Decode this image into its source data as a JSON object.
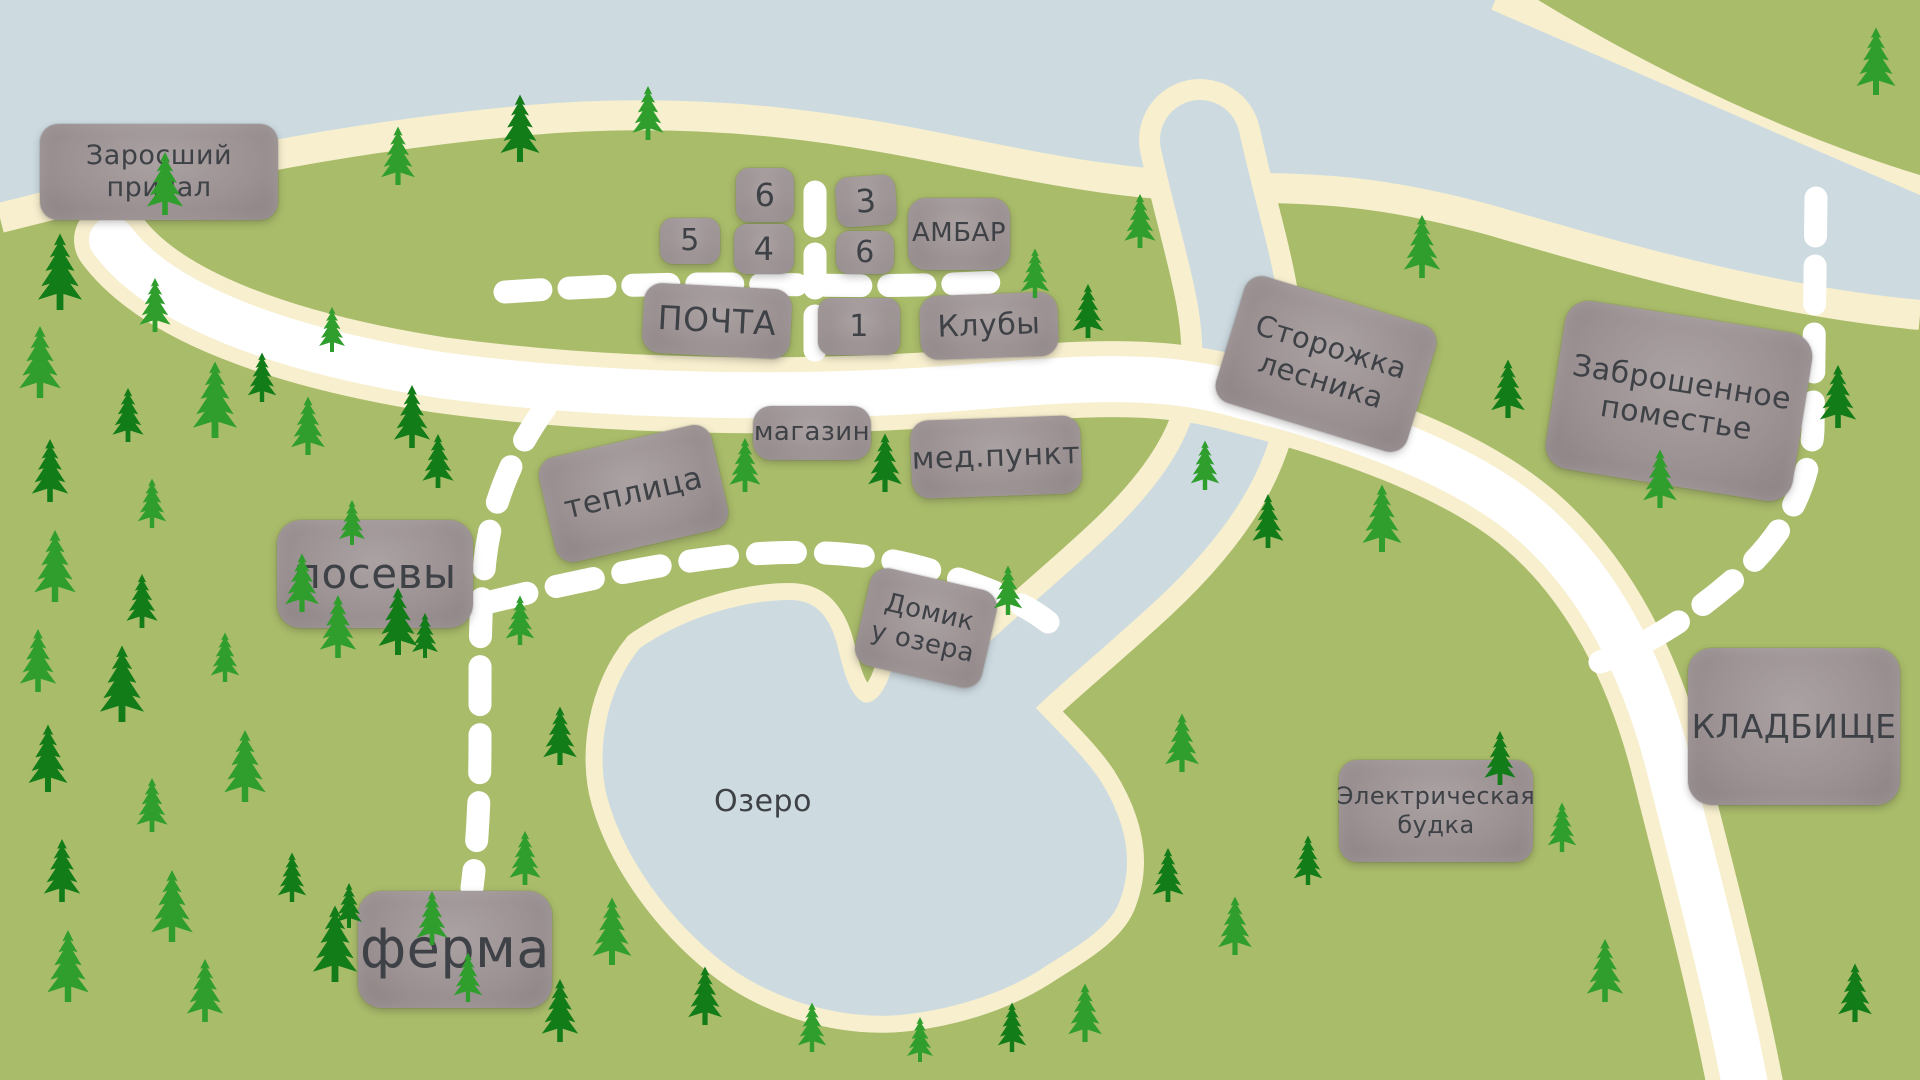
{
  "map_title": "Карта деревни",
  "colors": {
    "grass": "#a9bc6a",
    "water": "#cddbe1",
    "shore": "#f7efce",
    "road": "#ffffff",
    "box_fill": "#9b9192",
    "box_light": "#aba2a3",
    "box_dark": "#8b8182",
    "box_text": "#3e4146",
    "tree_bright": "#2f9e2c",
    "tree_dark": "#127c18"
  },
  "water_features": {
    "bay_label": "",
    "lake_label": "Озеро"
  },
  "places": [
    {
      "id": "zarosshiy-prichal",
      "label": "Заросший\nпричал",
      "x": 40,
      "y": 124,
      "w": 238,
      "h": 96,
      "rot": 0,
      "fs": 27,
      "cls": ""
    },
    {
      "id": "house-6a",
      "label": "6",
      "x": 736,
      "y": 168,
      "w": 58,
      "h": 54,
      "rot": 0,
      "fs": 32,
      "cls": "place--num"
    },
    {
      "id": "house-5",
      "label": "5",
      "x": 660,
      "y": 218,
      "w": 60,
      "h": 46,
      "rot": 0,
      "fs": 30,
      "cls": "place--num"
    },
    {
      "id": "house-4",
      "label": "4",
      "x": 734,
      "y": 224,
      "w": 60,
      "h": 50,
      "rot": 0,
      "fs": 32,
      "cls": "place--num"
    },
    {
      "id": "house-3",
      "label": "3",
      "x": 836,
      "y": 176,
      "w": 60,
      "h": 50,
      "rot": -4,
      "fs": 32,
      "cls": "place--num"
    },
    {
      "id": "house-6b",
      "label": "6",
      "x": 836,
      "y": 231,
      "w": 58,
      "h": 43,
      "rot": 0,
      "fs": 30,
      "cls": "place--num"
    },
    {
      "id": "ambar",
      "label": "АМБАР",
      "x": 908,
      "y": 198,
      "w": 102,
      "h": 72,
      "rot": 0,
      "fs": 26,
      "cls": ""
    },
    {
      "id": "pochta",
      "label": "ПОЧТА",
      "x": 643,
      "y": 286,
      "w": 148,
      "h": 70,
      "rot": 3,
      "fs": 33,
      "cls": ""
    },
    {
      "id": "house-1",
      "label": "1",
      "x": 818,
      "y": 298,
      "w": 82,
      "h": 57,
      "rot": 0,
      "fs": 30,
      "cls": "place--num"
    },
    {
      "id": "kluby",
      "label": "Клубы",
      "x": 920,
      "y": 294,
      "w": 138,
      "h": 64,
      "rot": -2,
      "fs": 30,
      "cls": ""
    },
    {
      "id": "magazin",
      "label": "магазин",
      "x": 753,
      "y": 406,
      "w": 118,
      "h": 54,
      "rot": 0,
      "fs": 26,
      "cls": ""
    },
    {
      "id": "med-punkt",
      "label": "мед.пункт",
      "x": 911,
      "y": 418,
      "w": 170,
      "h": 78,
      "rot": -2,
      "fs": 30,
      "cls": ""
    },
    {
      "id": "teplitsa",
      "label": "теплица",
      "x": 545,
      "y": 440,
      "w": 177,
      "h": 107,
      "rot": -13,
      "fs": 31,
      "cls": ""
    },
    {
      "id": "posevy",
      "label": "посевы",
      "x": 277,
      "y": 520,
      "w": 196,
      "h": 108,
      "rot": 0,
      "fs": 42,
      "cls": "place--big"
    },
    {
      "id": "domik-u-ozera",
      "label": "Домик\nу озера",
      "x": 861,
      "y": 578,
      "w": 130,
      "h": 100,
      "rot": 13,
      "fs": 26,
      "cls": ""
    },
    {
      "id": "storozhka-lesnika",
      "label": "Сторожка\nлесника",
      "x": 1226,
      "y": 298,
      "w": 200,
      "h": 132,
      "rot": 17,
      "fs": 29,
      "cls": ""
    },
    {
      "id": "zabroshennoe-pomestye",
      "label": "Заброшенное\nпоместье",
      "x": 1554,
      "y": 316,
      "w": 250,
      "h": 170,
      "rot": 9,
      "fs": 30,
      "cls": "place--big"
    },
    {
      "id": "kladbishche",
      "label": "КЛАДБИЩЕ",
      "x": 1688,
      "y": 648,
      "w": 212,
      "h": 157,
      "rot": 0,
      "fs": 33,
      "cls": "place--big"
    },
    {
      "id": "elektricheskaya-budka",
      "label": "Электрическая\nбудка",
      "x": 1339,
      "y": 760,
      "w": 194,
      "h": 102,
      "rot": 0,
      "fs": 24,
      "cls": ""
    },
    {
      "id": "ferma",
      "label": "ферма",
      "x": 358,
      "y": 891,
      "w": 194,
      "h": 117,
      "rot": 0,
      "fs": 54,
      "cls": "place--big"
    },
    {
      "id": "ozero",
      "label": "Озеро",
      "x": 688,
      "y": 780,
      "w": 150,
      "h": 44,
      "rot": 0,
      "fs": 30,
      "cls": "place--text"
    }
  ],
  "trees": [
    [
      165,
      215,
      0.7,
      0
    ],
    [
      398,
      185,
      0.65,
      0
    ],
    [
      520,
      162,
      0.75,
      1
    ],
    [
      648,
      140,
      0.6,
      0
    ],
    [
      60,
      310,
      0.85,
      1
    ],
    [
      155,
      332,
      0.6,
      0
    ],
    [
      40,
      398,
      0.8,
      0
    ],
    [
      128,
      442,
      0.6,
      1
    ],
    [
      215,
      438,
      0.85,
      0
    ],
    [
      50,
      502,
      0.7,
      1
    ],
    [
      152,
      528,
      0.55,
      0
    ],
    [
      262,
      402,
      0.55,
      1
    ],
    [
      332,
      352,
      0.5,
      0
    ],
    [
      308,
      455,
      0.65,
      0
    ],
    [
      412,
      448,
      0.7,
      1
    ],
    [
      352,
      545,
      0.5,
      0
    ],
    [
      438,
      488,
      0.6,
      1
    ],
    [
      55,
      602,
      0.8,
      0
    ],
    [
      142,
      628,
      0.6,
      1
    ],
    [
      38,
      692,
      0.7,
      0
    ],
    [
      122,
      722,
      0.85,
      1
    ],
    [
      225,
      682,
      0.55,
      0
    ],
    [
      48,
      792,
      0.75,
      1
    ],
    [
      152,
      832,
      0.6,
      0
    ],
    [
      245,
      802,
      0.8,
      0
    ],
    [
      62,
      902,
      0.7,
      1
    ],
    [
      172,
      942,
      0.8,
      0
    ],
    [
      292,
      902,
      0.55,
      1
    ],
    [
      68,
      1002,
      0.8,
      0
    ],
    [
      205,
      1022,
      0.7,
      0
    ],
    [
      335,
      982,
      0.85,
      1
    ],
    [
      432,
      945,
      0.6,
      0
    ],
    [
      302,
      612,
      0.65,
      0
    ],
    [
      398,
      655,
      0.75,
      1
    ],
    [
      338,
      658,
      0.7,
      0
    ],
    [
      425,
      658,
      0.5,
      1
    ],
    [
      520,
      645,
      0.55,
      0
    ],
    [
      560,
      765,
      0.65,
      1
    ],
    [
      525,
      885,
      0.6,
      0
    ],
    [
      612,
      965,
      0.75,
      0
    ],
    [
      705,
      1025,
      0.65,
      1
    ],
    [
      812,
      1052,
      0.55,
      0
    ],
    [
      560,
      1042,
      0.7,
      1
    ],
    [
      468,
      1002,
      0.55,
      0
    ],
    [
      349,
      928,
      0.5,
      1
    ],
    [
      920,
      1062,
      0.5,
      0
    ],
    [
      745,
      492,
      0.6,
      0
    ],
    [
      885,
      492,
      0.65,
      1
    ],
    [
      1008,
      615,
      0.55,
      0
    ],
    [
      1035,
      298,
      0.55,
      0
    ],
    [
      1088,
      338,
      0.6,
      1
    ],
    [
      1140,
      248,
      0.6,
      0
    ],
    [
      1205,
      490,
      0.55,
      0
    ],
    [
      1268,
      548,
      0.6,
      1
    ],
    [
      1422,
      278,
      0.7,
      0
    ],
    [
      1508,
      418,
      0.65,
      1
    ],
    [
      1382,
      552,
      0.75,
      0
    ],
    [
      1660,
      508,
      0.65,
      0
    ],
    [
      1838,
      428,
      0.7,
      1
    ],
    [
      1876,
      95,
      0.75,
      0
    ],
    [
      1500,
      785,
      0.6,
      1
    ],
    [
      1182,
      772,
      0.65,
      0
    ],
    [
      1168,
      902,
      0.6,
      1
    ],
    [
      1235,
      955,
      0.65,
      0
    ],
    [
      1308,
      885,
      0.55,
      1
    ],
    [
      1085,
      1042,
      0.65,
      0
    ],
    [
      1012,
      1052,
      0.55,
      1
    ],
    [
      1605,
      1002,
      0.7,
      0
    ],
    [
      1855,
      1022,
      0.65,
      1
    ],
    [
      1562,
      852,
      0.55,
      0
    ]
  ]
}
